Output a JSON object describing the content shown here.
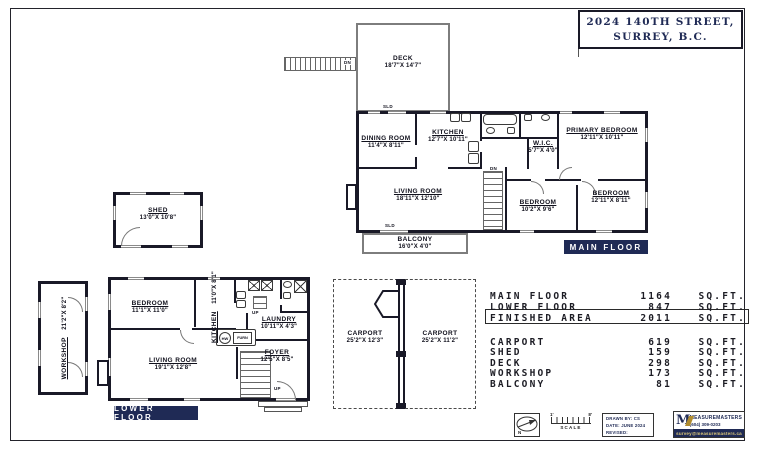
{
  "title": {
    "line1": "2024 140TH STREET,",
    "line2": "SURREY, B.C."
  },
  "floors": {
    "main": {
      "label": "MAIN FLOOR"
    },
    "lower": {
      "label": "LOWER FLOOR"
    }
  },
  "rooms": {
    "deck": {
      "name": "DECK",
      "dims": "18'7\"X 14'7\""
    },
    "dining": {
      "name": "DINING ROOM",
      "dims": "11'4\"X 8'11\""
    },
    "kitchen_main": {
      "name": "KITCHEN",
      "dims": "12'7\"X 10'11\""
    },
    "primary": {
      "name": "PRIMARY BEDROOM",
      "dims": "12'11\"X 10'11\""
    },
    "wic": {
      "name": "W.I.C.",
      "dims": "5'7\"X 4'0\""
    },
    "living_main": {
      "name": "LIVING ROOM",
      "dims": "18'11\"X 12'10\""
    },
    "bedroom_mid": {
      "name": "BEDROOM",
      "dims": "10'2\"X 9'6\""
    },
    "bedroom_right": {
      "name": "BEDROOM",
      "dims": "12'11\"X 8'11\""
    },
    "balcony": {
      "name": "BALCONY",
      "dims": "16'0\"X 4'0\""
    },
    "shed": {
      "name": "SHED",
      "dims": "13'0\"X 10'8\""
    },
    "workshop": {
      "name": "WORKSHOP",
      "dims": "21'2\"X 8'2\""
    },
    "bedroom_lower": {
      "name": "BEDROOM",
      "dims": "11'1\"X 11'0\""
    },
    "kitchen_lower": {
      "name": "KITCHEN",
      "dims": "11'0\"X 8'1\""
    },
    "laundry": {
      "name": "LAUNDRY",
      "dims": "10'11\"X 4'3\""
    },
    "living_lower": {
      "name": "LIVING ROOM",
      "dims": "19'1\"X 12'8\""
    },
    "foyer": {
      "name": "FOYER",
      "dims": "12'5\"X 8'5\""
    },
    "carport_left": {
      "name": "CARPORT",
      "dims": "25'2\"X 12'3\""
    },
    "carport_right": {
      "name": "CARPORT",
      "dims": "25'2\"X 11'2\""
    }
  },
  "annotations": {
    "dn": "DN",
    "up": "UP",
    "sld": "SLD",
    "hw": "HW",
    "furn": "FURN",
    "north": "N"
  },
  "area_table": {
    "rows": [
      {
        "label": "MAIN FLOOR",
        "value": "1164",
        "unit": "SQ.FT."
      },
      {
        "label": "LOWER FLOOR",
        "value": "847",
        "unit": "SQ.FT."
      },
      {
        "label": "FINISHED AREA",
        "value": "2011",
        "unit": "SQ.FT."
      },
      {
        "label": "CARPORT",
        "value": "619",
        "unit": "SQ.FT."
      },
      {
        "label": "SHED",
        "value": "159",
        "unit": "SQ.FT."
      },
      {
        "label": "DECK",
        "value": "298",
        "unit": "SQ.FT."
      },
      {
        "label": "WORKSHOP",
        "value": "173",
        "unit": "SQ.FT."
      },
      {
        "label": "BALCONY",
        "value": "81",
        "unit": "SQ.FT."
      }
    ]
  },
  "footer": {
    "scale_label": "SCALE",
    "scale_left": "1'",
    "scale_right": "8'",
    "drawn_by": "DRAWN BY: CS",
    "date": "DATE: JUNE 2024",
    "revised": "REVISED:",
    "company": "MEASUREMASTERS",
    "phone": "(604) 309-0203",
    "email": "survey@measuremasters.ca",
    "logo_letter": "M"
  },
  "colors": {
    "navy": "#1f2a55",
    "wall": "#191927"
  }
}
